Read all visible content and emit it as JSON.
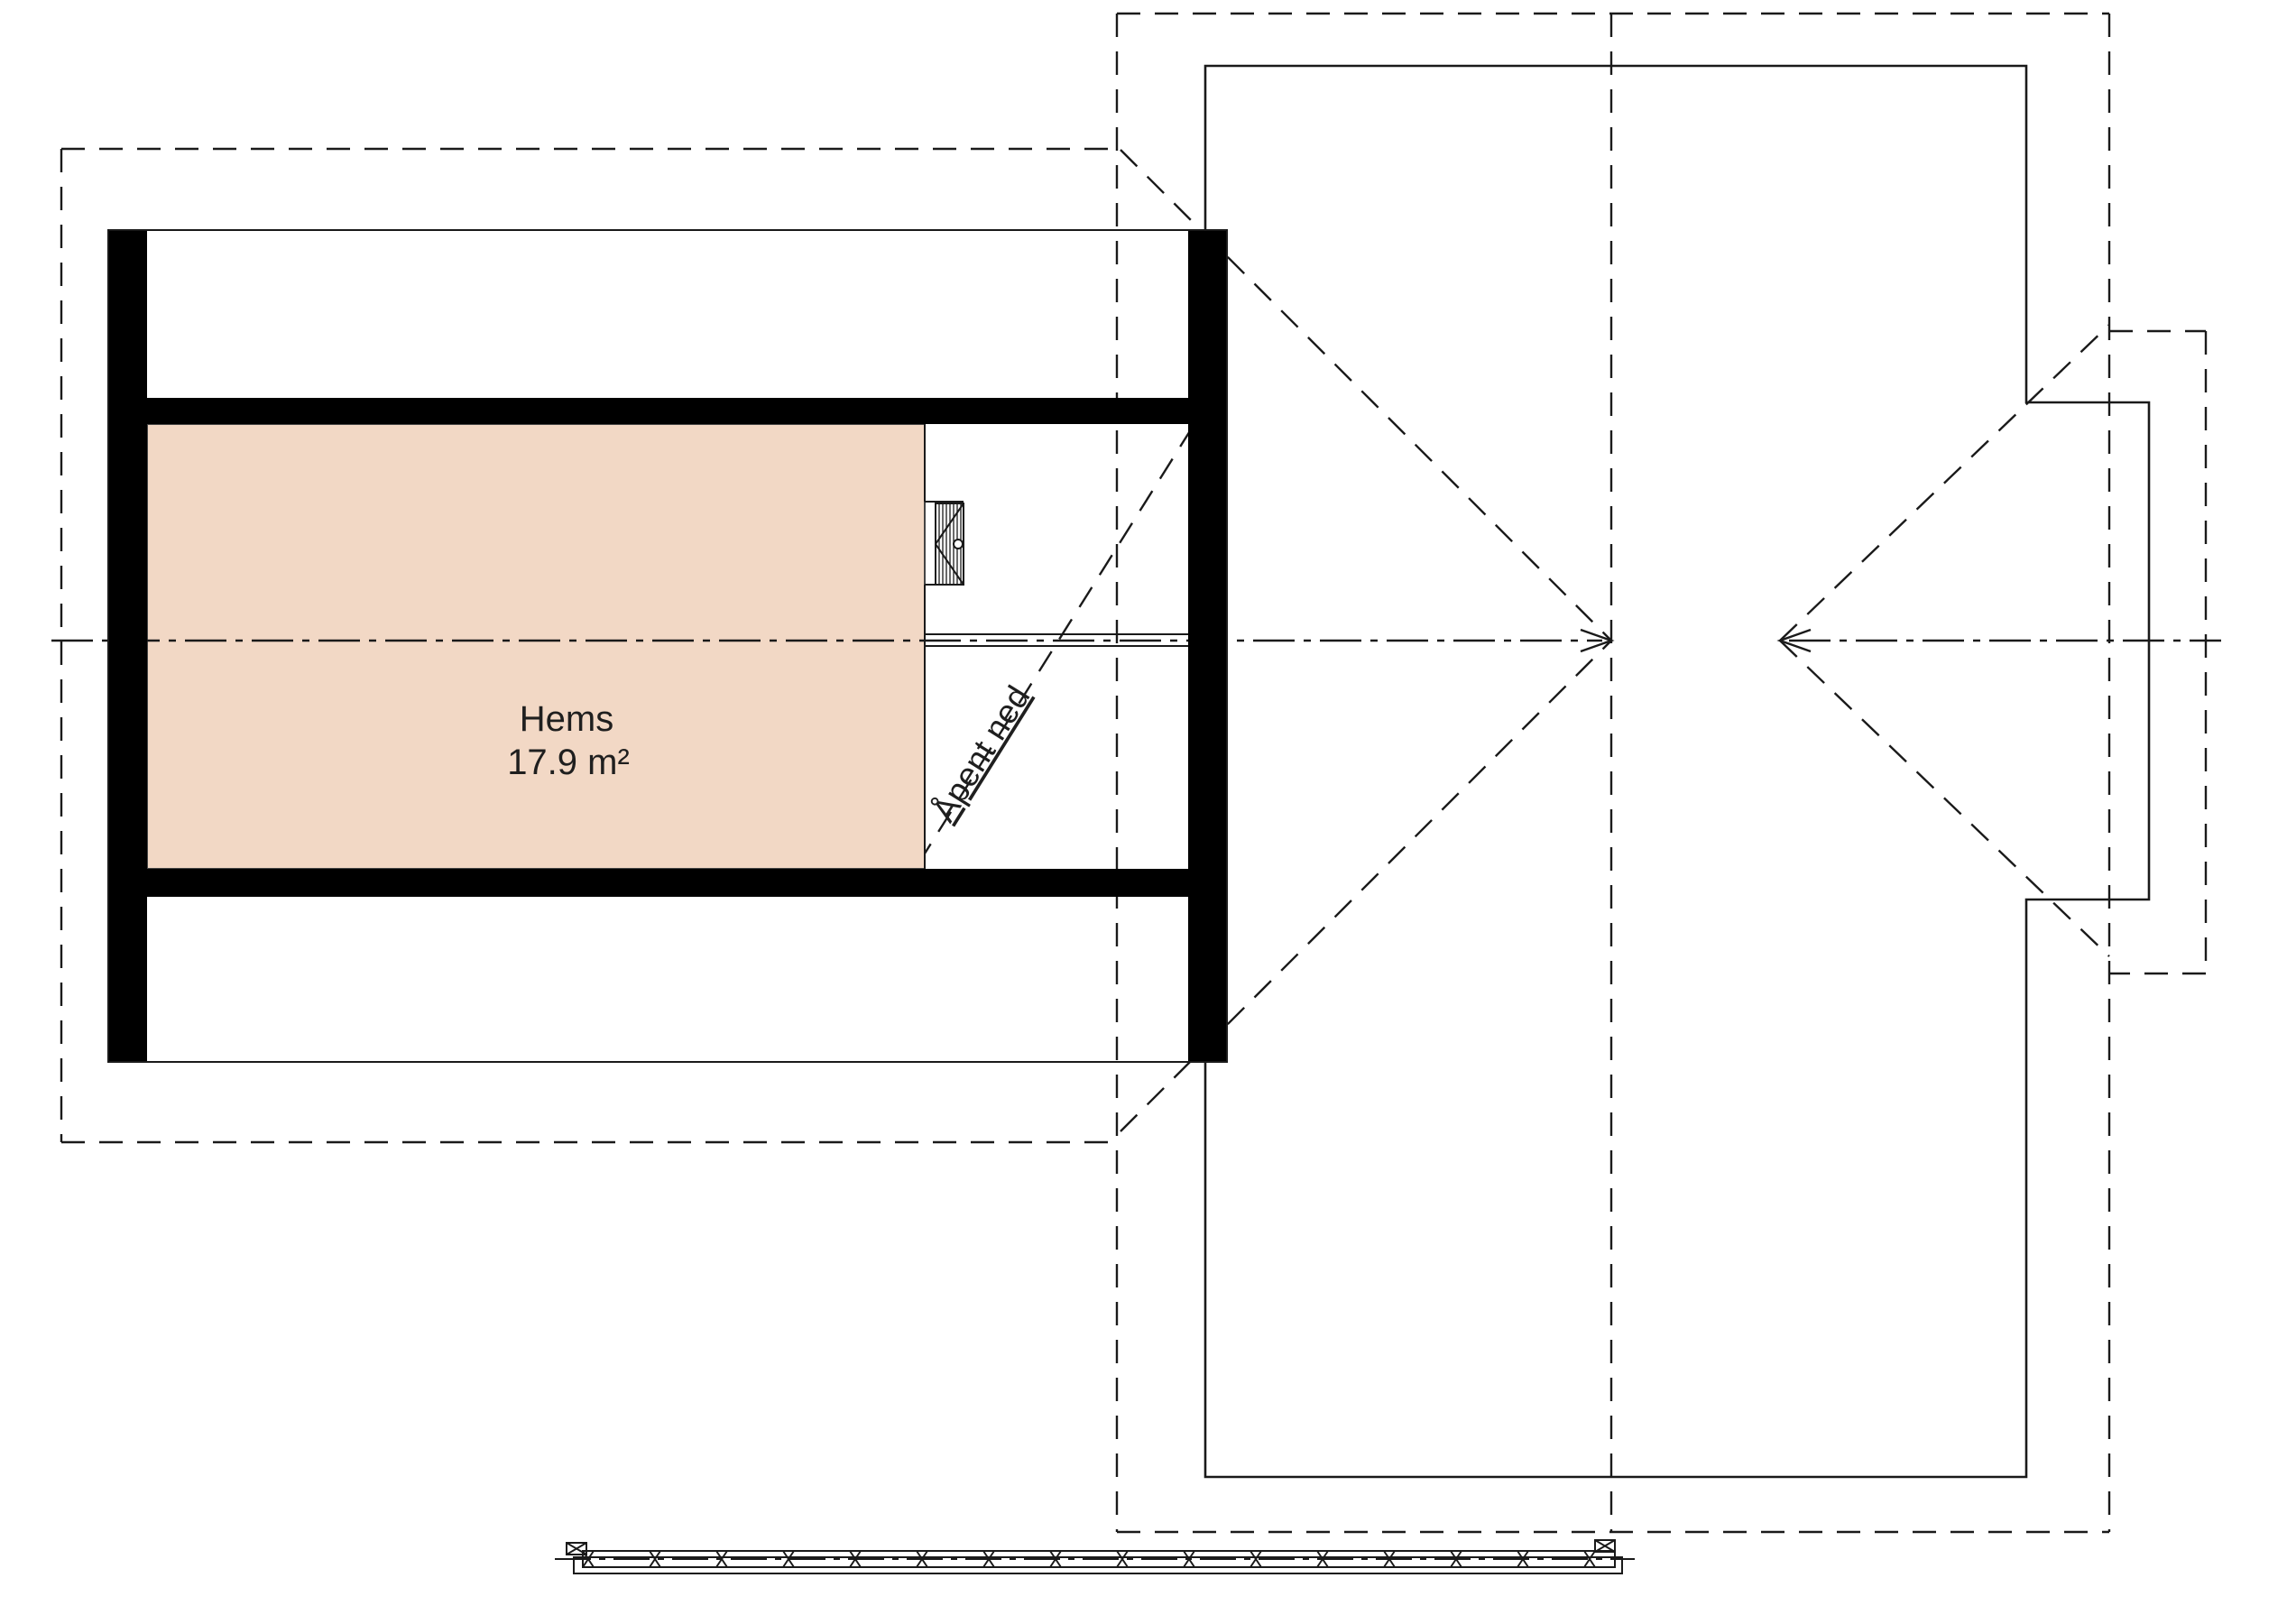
{
  "drawing": {
    "type": "architectural-floor-plan",
    "floor": "loft",
    "labels": {
      "room_name": "Hems",
      "room_area": "17.9 m²",
      "opening_note": "Åpent ned"
    },
    "colors": {
      "room_fill": "#f2d8c5",
      "line": "#1a1a1a",
      "wall": "#000000",
      "background": "#ffffff"
    }
  }
}
